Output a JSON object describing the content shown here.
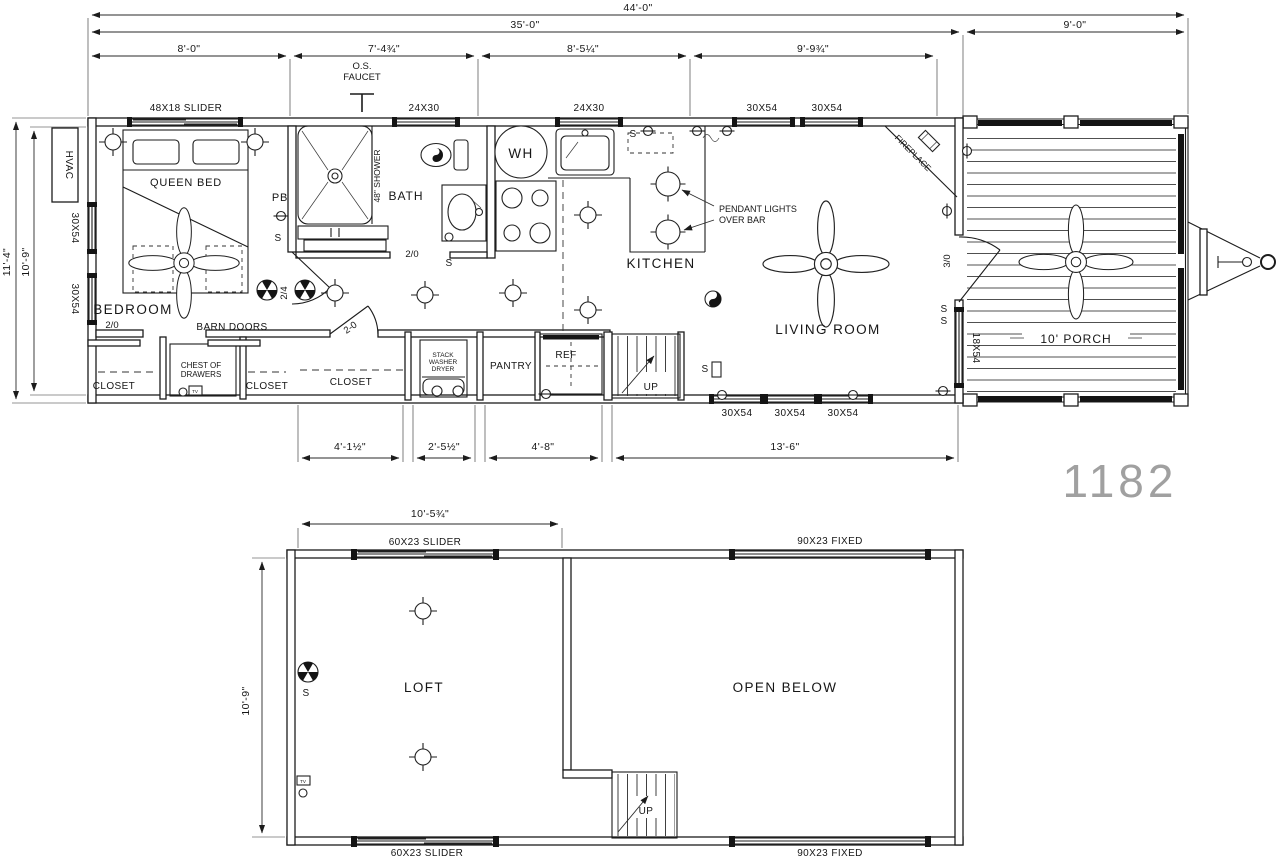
{
  "model_number": "1182",
  "symbols": {
    "switch": "S",
    "tv": "TV"
  },
  "main_plan": {
    "dims": {
      "overall_width": "44'-0\"",
      "cabin_width": "35'-0\"",
      "porch_width": "9'-0\"",
      "seg_bedroom": "8'-0\"",
      "seg_bath": "7'-4¾\"",
      "seg_kitchen": "8'-5¼\"",
      "seg_living": "9'-9¾\"",
      "height_overall": "11'-4\"",
      "height_interior": "10'-9\"",
      "closet_width": "4'-1½\"",
      "washer_width": "2'-5½\"",
      "pantry_ref_width": "4'-8\"",
      "living_bottom_width": "13'-6\""
    },
    "windows": {
      "bedroom_slider": "48X18 SLIDER",
      "bath": "24X30",
      "kitchen": "24X30",
      "living_top_1": "30X54",
      "living_top_2": "30X54",
      "left_1": "30X54",
      "left_2": "30X54",
      "bottom_1": "30X54",
      "bottom_2": "30X54",
      "bottom_3": "30X54",
      "porch_wall": "18X54"
    },
    "rooms": {
      "bedroom": "BEDROOM",
      "bath": "BATH",
      "kitchen": "KITCHEN",
      "living": "LIVING ROOM",
      "porch": "10' PORCH",
      "closet_1": "CLOSET",
      "closet_2": "CLOSET",
      "closet_3": "CLOSET",
      "pantry": "PANTRY"
    },
    "labels": {
      "queen_bed": "QUEEN BED",
      "barn_doors": "BARN DOORS",
      "chest_line1": "CHEST OF",
      "chest_line2": "DRAWERS",
      "stack_line1": "STACK",
      "stack_line2": "WASHER",
      "stack_line3": "DRYER",
      "ref": "REF",
      "hvac": "HVAC",
      "os_line1": "O.S.",
      "os_line2": "FAUCET",
      "pendant_line1": "PENDANT LIGHTS",
      "pendant_line2": "OVER BAR",
      "fireplace": "FIREPLACE",
      "shower": "48\" SHOWER",
      "pb": "PB",
      "wh": "WH",
      "up": "UP"
    },
    "doors": {
      "bedroom_closet": "2/0",
      "hall": "2/4",
      "closet": "2-0",
      "bath": "2/0",
      "porch": "3/0"
    }
  },
  "loft_plan": {
    "dims": {
      "loft_width": "10'-5¾\"",
      "loft_depth": "10'-9\""
    },
    "windows": {
      "slider_top": "60X23 SLIDER",
      "fixed_top": "90X23 FIXED",
      "slider_bottom": "60X23 SLIDER",
      "fixed_bottom": "90X23 FIXED"
    },
    "rooms": {
      "loft": "LOFT",
      "open_below": "OPEN BELOW"
    },
    "labels": {
      "up": "UP"
    }
  }
}
